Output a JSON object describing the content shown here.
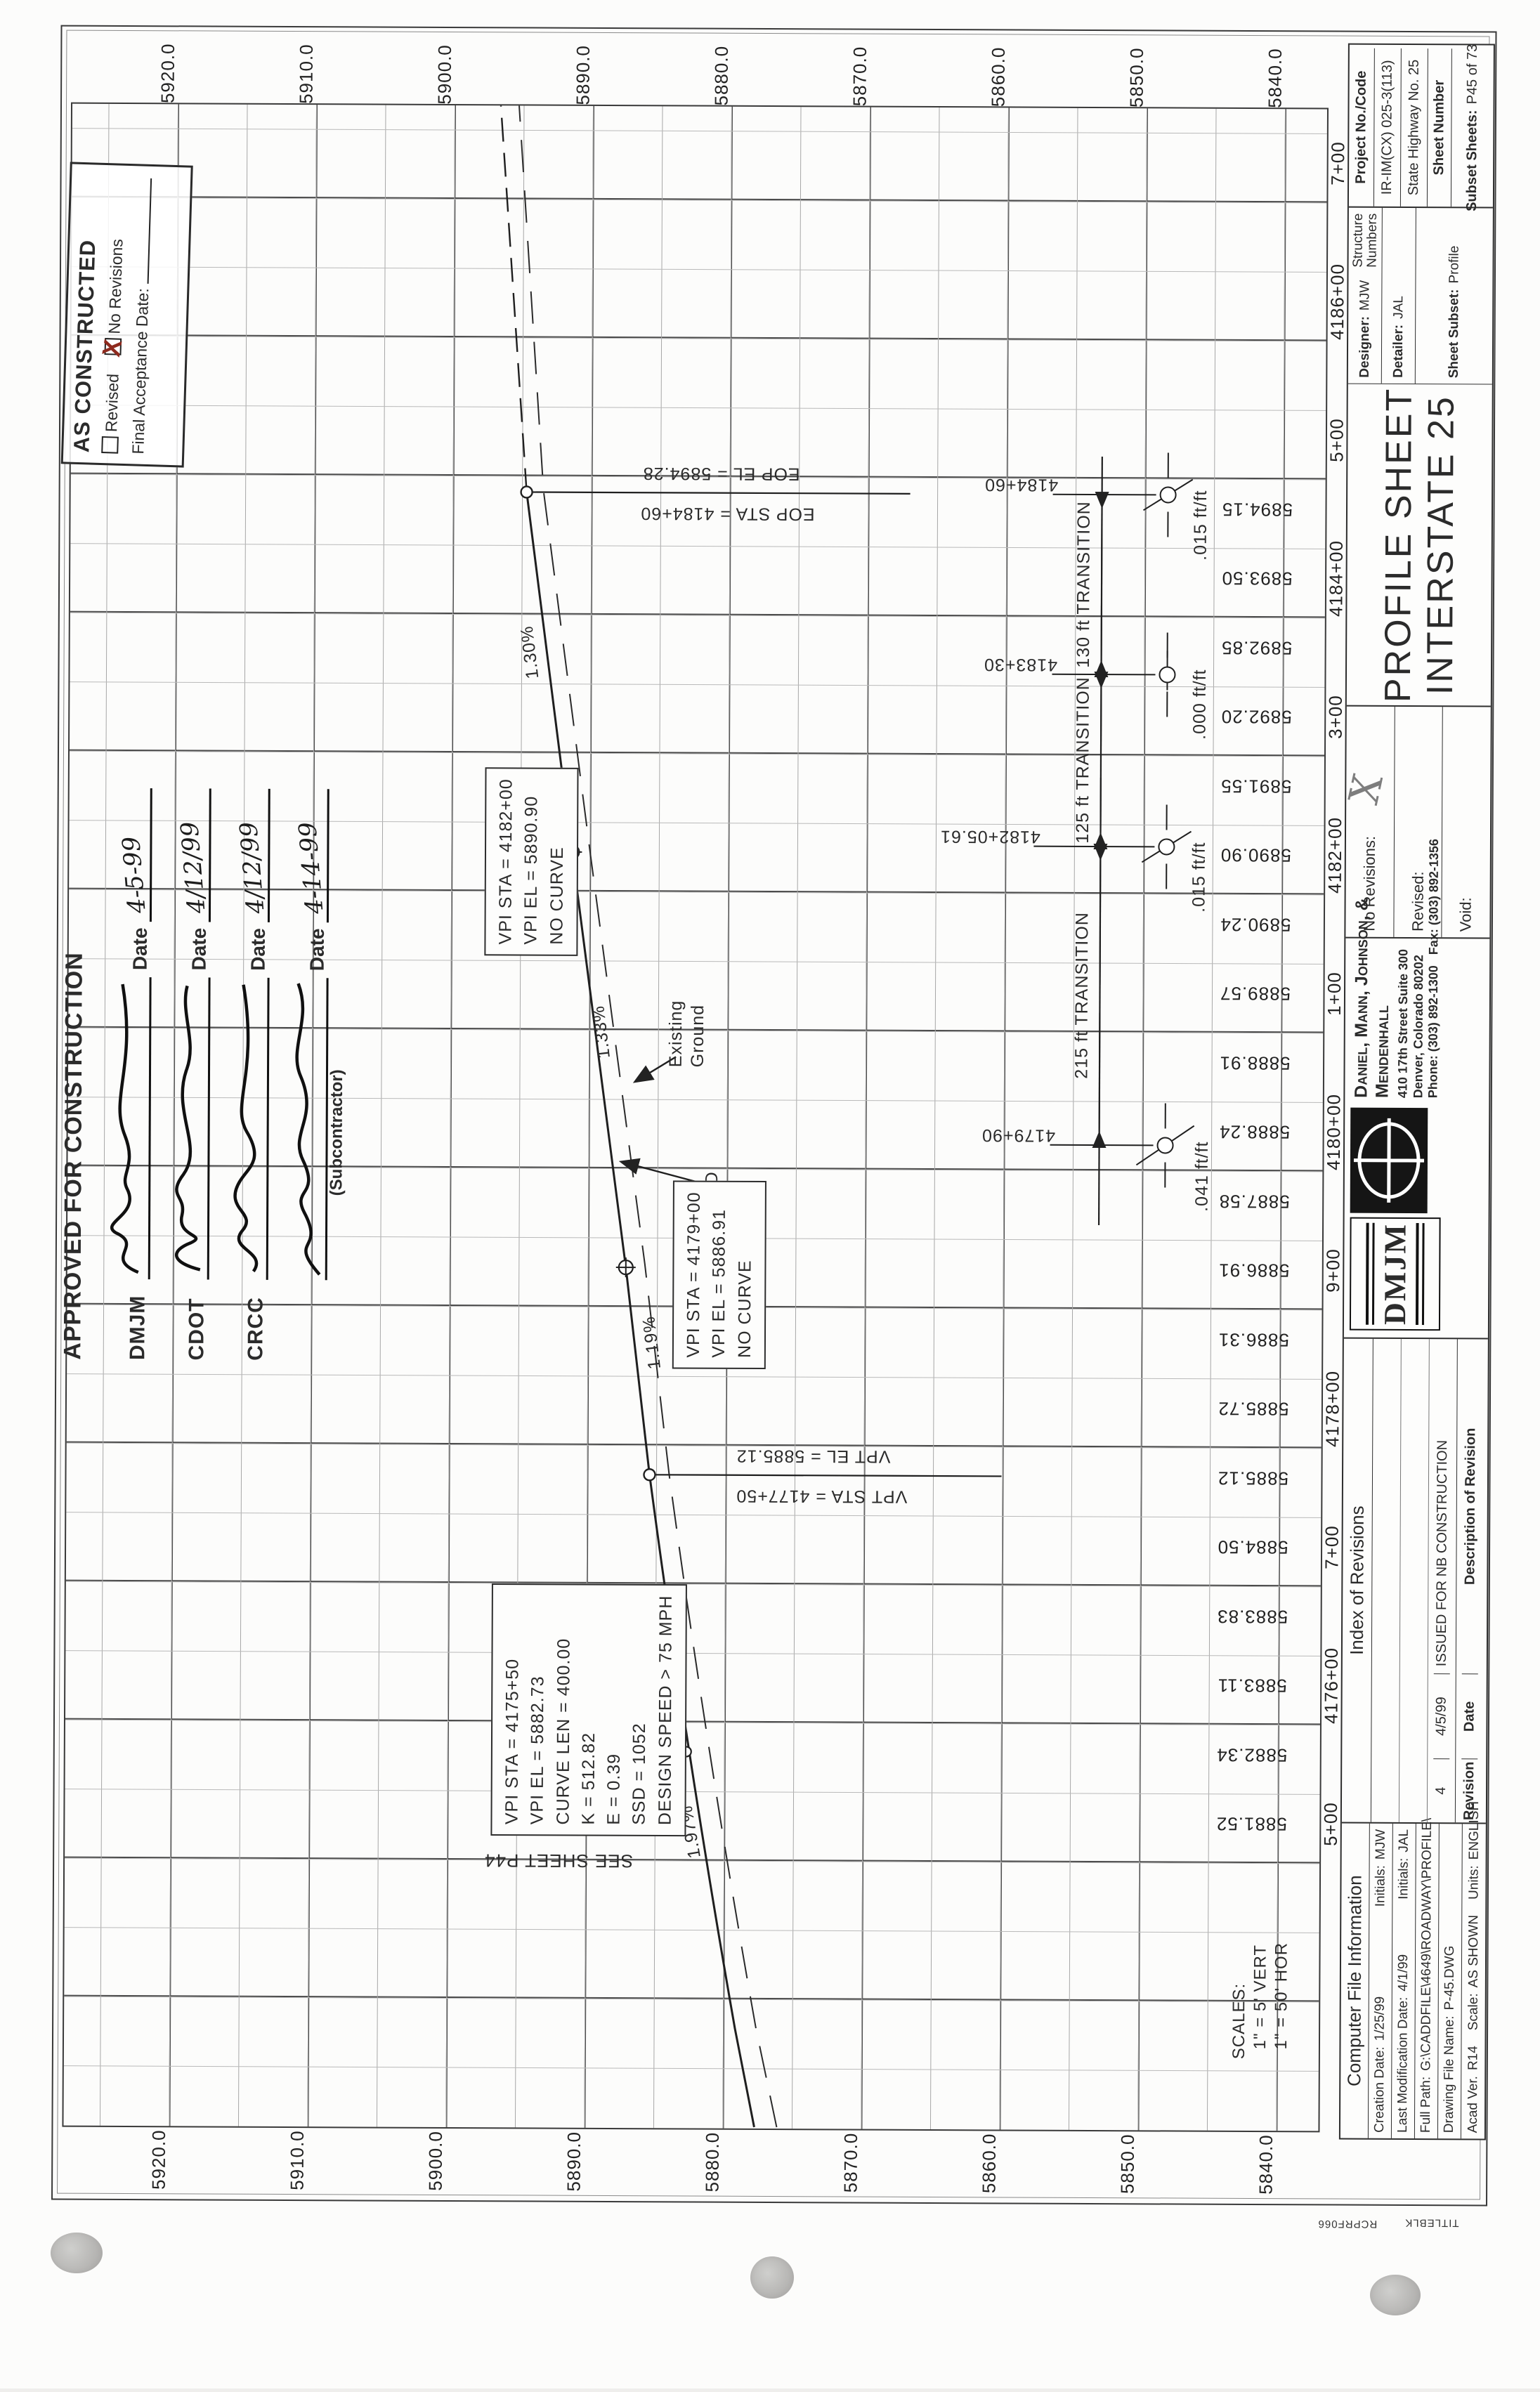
{
  "grid": {
    "elevation_labels": [
      "5920.0",
      "5910.0",
      "5900.0",
      "5890.0",
      "5880.0",
      "5870.0",
      "5860.0",
      "5850.0",
      "5840.0"
    ],
    "station_labels": [
      "5+00",
      "4176+00",
      "7+00",
      "4178+00",
      "9+00",
      "4180+00",
      "1+00",
      "4182+00",
      "3+00",
      "4184+00",
      "5+00",
      "4186+00",
      "7+00"
    ],
    "grade_elevations": [
      "5881.52",
      "5882.34",
      "5883.11",
      "5883.83",
      "5884.50",
      "5885.12",
      "5885.72",
      "5886.31",
      "5886.91",
      "5887.58",
      "5888.24",
      "5888.91",
      "5889.57",
      "5890.24",
      "5890.90",
      "5891.55",
      "5892.20",
      "5892.85",
      "5893.50",
      "5894.15"
    ]
  },
  "callouts": {
    "vpi_4182": [
      "VPI STA = 4182+00",
      "VPI EL = 5890.90",
      "NO CURVE"
    ],
    "vpi_4179": [
      "VPI STA = 4179+00",
      "VPI EL = 5886.91",
      "NO CURVE"
    ],
    "curve_box": [
      "VPI STA = 4175+50",
      "VPI EL = 5882.73",
      "CURVE LEN = 400.00",
      "K = 512.82",
      "E = 0.39",
      "SSD = 1052",
      "DESIGN SPEED > 75 MPH"
    ],
    "eop_el": "EOP EL = 5894.28",
    "eop_sta": "EOP STA = 4184+60",
    "vpt_el": "VPT EL = 5885.12",
    "vpt_sta": "VPT STA = 4177+50",
    "grade_130": "1.30%",
    "grade_133": "1.33%",
    "grade_119": "1.19%",
    "grade_197": "1.97%",
    "existing_ground_1": "Existing",
    "existing_ground_2": "Ground",
    "finished_grade_1": "FINISHED",
    "finished_grade_2": "GRADE",
    "see_sheet": "SEE SHEET P44"
  },
  "superelevation": {
    "sta_4184_60": "4184+60",
    "rate_1": ".015 ft/ft",
    "sta_4183_30": "4183+30",
    "rate_2": ".000 ft/ft",
    "sta_4182_05": "4182+05.61",
    "rate_3": ".015 ft/ft",
    "sta_4179_90": "4179+90",
    "rate_4": ".041 ft/ft",
    "span_130": "130 ft TRANSITION",
    "span_125": "125 ft TRANSITION",
    "span_215": "215 ft TRANSITION"
  },
  "scales": {
    "title": "SCALES:",
    "vert": "1\" = 5' VERT",
    "hor": "1\" = 50' HOR"
  },
  "stamps": {
    "as_constructed": {
      "title": "AS CONSTRUCTED",
      "revised": "Revised",
      "no_revisions": "No Revisions",
      "mark": "X",
      "final_label": "Final Acceptance Date:"
    },
    "approved": {
      "title": "APPROVED FOR CONSTRUCTION",
      "rows": [
        {
          "label": "DMJM",
          "date_label": "Date",
          "date": "4-5-99"
        },
        {
          "label": "CDOT",
          "date_label": "Date",
          "date": "4/12/99"
        },
        {
          "label": "CRCC",
          "date_label": "Date",
          "date": "4/12/99"
        },
        {
          "label": "",
          "date_label": "Date",
          "date": "4-14-99"
        }
      ],
      "subcontractor": "(Subcontractor)"
    }
  },
  "title_block": {
    "cfi": {
      "title": "Computer File Information",
      "creation_label": "Creation Date:",
      "creation": "1/25/99",
      "initials_label": "Initials:",
      "creation_initials": "MJW",
      "mod_label": "Last Modification Date:",
      "mod": "4/1/99",
      "mod_initials": "JAL",
      "path_label": "Full Path:",
      "path": "G:\\CADDFILE\\4649\\ROADWAY\\PROFILE\\",
      "file_label": "Drawing File Name:",
      "file": "P-45.DWG",
      "acad_label": "Acad Ver.",
      "acad": "R14",
      "scale_label": "Scale:",
      "scale": "AS SHOWN",
      "units_label": "Units:",
      "units": "ENGLISH"
    },
    "ior": {
      "title": "Index of Revisions",
      "rev_no": "4",
      "rev_date": "4/5/99",
      "rev_desc": "ISSUED FOR NB CONSTRUCTION",
      "h_rev": "Revision",
      "h_date": "Date",
      "h_desc": "Description of Revision"
    },
    "dmjm": {
      "logo": "DMJM",
      "name1": "Daniel, Mann, Johnson, &",
      "name2": "Mendenhall",
      "addr1": "410 17th Street Suite 300",
      "addr2": "Denver, Colorado 80202",
      "phone": "Phone: (303) 892-1300",
      "fax": "Fax: (303) 892-1356"
    },
    "voidbox": {
      "no_revisions": "No Revisions:",
      "revised": "Revised:",
      "voidl": "Void:",
      "mark": "X"
    },
    "sheet": {
      "title1": "PROFILE SHEET",
      "title2": "INTERSTATE 25",
      "designer_label": "Designer:",
      "designer": "MJW",
      "detailer_label": "Detailer:",
      "detailer": "JAL",
      "structure1": "Structure",
      "structure2": "Numbers",
      "subset_label": "Sheet Subset:",
      "subset": "Profile",
      "subsheets_label": "Subset Sheets:",
      "subsheets": "P45 of 73"
    },
    "project": {
      "code_label": "Project No./Code",
      "code": "IR-IM(CX) 025-3(113)",
      "highway": "State Highway No. 25",
      "sheet_number_label": "Sheet Number"
    },
    "corner1": "TITLEBLK",
    "corner2": "RCPRF066"
  }
}
